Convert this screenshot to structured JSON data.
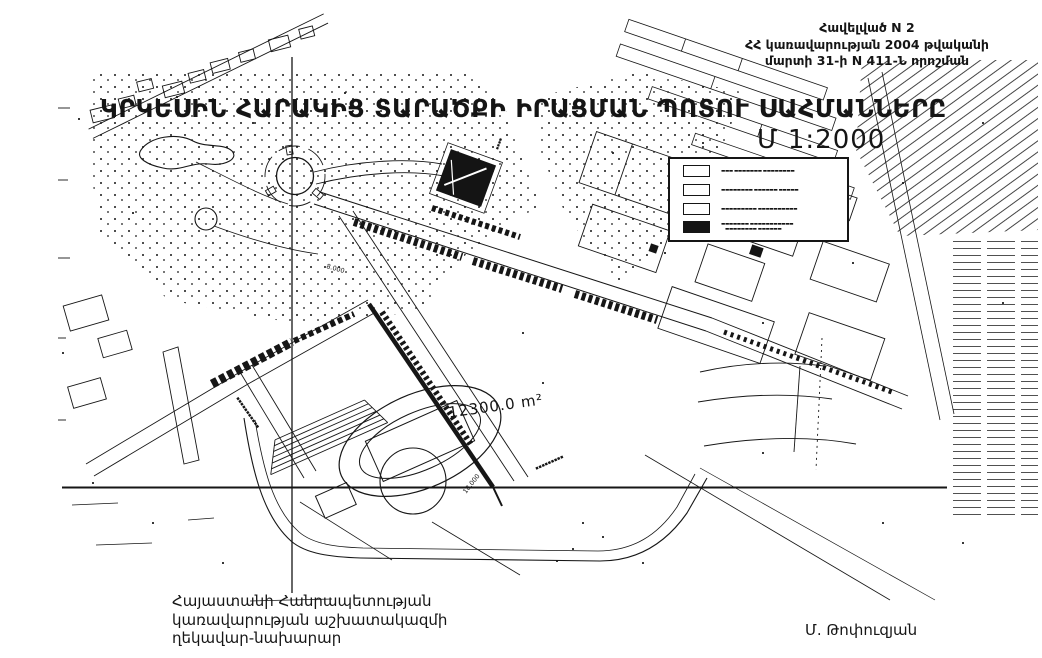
{
  "page": {
    "background": "#ffffff",
    "ink": "#151515"
  },
  "header": {
    "appendix_line1": "Հավելված N 2",
    "appendix_line2": "ՀՀ կառավարության 2004 թվականի",
    "appendix_line3": "մարտի 31-ի N 411-Ն որոշման",
    "title": "ԿՐԿԵՍԻՆ ՀԱՐԱԿԻՑ ՏԱՐԱԾՔԻ ԻՐԱՑՄԱՆ ՊՈՏՈՒ ՍԱՀՄԱՆՆԵՐԸ",
    "scale": "Մ  1:2000"
  },
  "legend": {
    "items": [
      {
        "swatch": "white",
        "label": "▬▬▬ ▬▬▬▬▬▬▬ ▬▬▬▬▬▬▬▬"
      },
      {
        "swatch": "white",
        "label": "▬▬▬▬▬▬▬▬ ▬▬▬▬▬▬ ▬▬▬▬▬"
      },
      {
        "swatch": "white",
        "label": "▬▬▬▬▬▬▬▬▬ ▬▬▬▬▬▬▬▬▬▬"
      },
      {
        "swatch": "black",
        "label": "▬▬▬▬▬▬▬ ▬▬▬▬▬▬▬▬▬▬▬",
        "label2": "▬▬▬▬▬▬▬▬ ▬▬▬▬▬▬"
      }
    ]
  },
  "map": {
    "area_label": "12300.0 m²",
    "dist_label_1": "18.000",
    "dist_label_2": "8.000",
    "street_label_1": "▪▪▪▪▪▪▪▪▪▪▪",
    "street_label_2": "▪▪▪▪▪▪▪▪▪",
    "street_label_3": "▪▪▪▪"
  },
  "footer": {
    "left_line1": "Հայաստանի Հանրապետության",
    "left_line2": "կառավարության աշխատակազմի",
    "left_line3": "ղեկավար-նախարար",
    "right_signature": "Մ. Թոփուզյան"
  }
}
